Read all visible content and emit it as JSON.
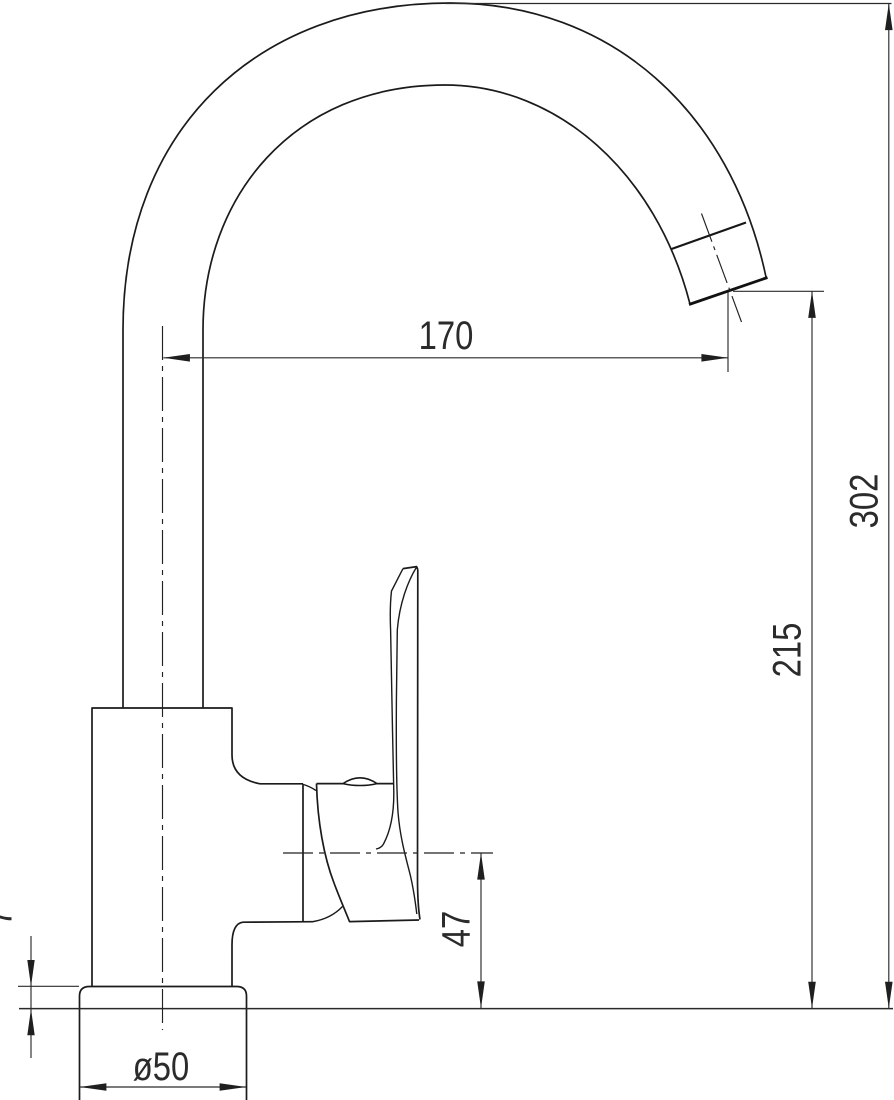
{
  "canvas": {
    "background": "#ffffff",
    "line_color": "#1b1b1b",
    "dimension_color": "#2b2b2b"
  },
  "drawing": {
    "dimensions": {
      "spout_reach": "170",
      "overall_height": "302",
      "outlet_height": "215",
      "pivot_to_counter": "47",
      "base_plate_height": "7",
      "base_diameter": "ø50"
    }
  }
}
